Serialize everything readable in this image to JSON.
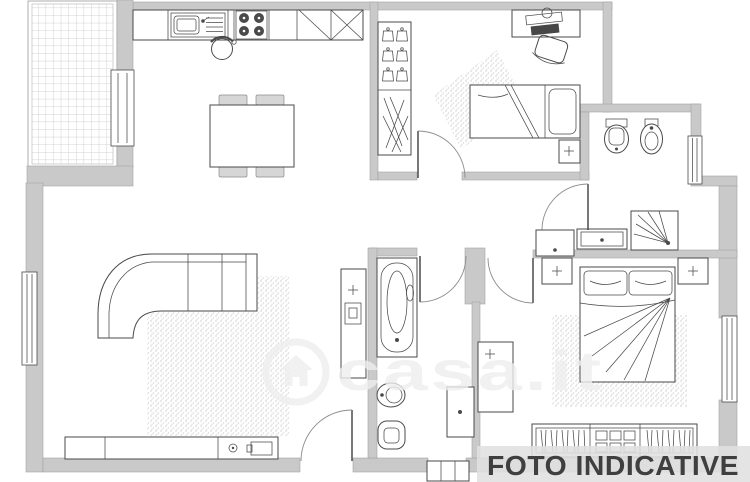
{
  "banner": {
    "label": "FOTO INDICATIVE"
  },
  "watermark": {
    "label": "casa.it",
    "logo": "house-in-circle-icon"
  },
  "colors": {
    "background": "#ffffff",
    "wall": "#c9c9c9",
    "wall_edge": "#a3a3a3",
    "line": "#4a4a4a",
    "soft_line": "#8d8d8d",
    "chair_fill": "#d6d6d6",
    "banner_bg": "rgba(224,224,224,0.88)",
    "banner_text": "#3f3f3f",
    "watermark_color": "rgba(238,238,238,0.8)"
  },
  "fixtures": [
    "terrace-tiled",
    "kitchen-counter",
    "kitchen-sink",
    "stove-burners",
    "wall-cabinets",
    "kitchen-stool",
    "dining-table",
    "dining-chairs",
    "corner-sofa",
    "living-rug",
    "tv-sideboard",
    "media-cabinet",
    "wardrobe-hangers",
    "shoe-rack",
    "desk",
    "desk-chair",
    "single-bed",
    "bedroom1-rug",
    "nightstand",
    "toilet",
    "bidet",
    "shower",
    "vanity-cabinet",
    "hall-cabinet",
    "bathtub",
    "washing-machine",
    "double-bed",
    "master-rug",
    "master-wardrobe",
    "master-cabinet",
    "entrance-steps",
    "windows",
    "door-swings"
  ]
}
